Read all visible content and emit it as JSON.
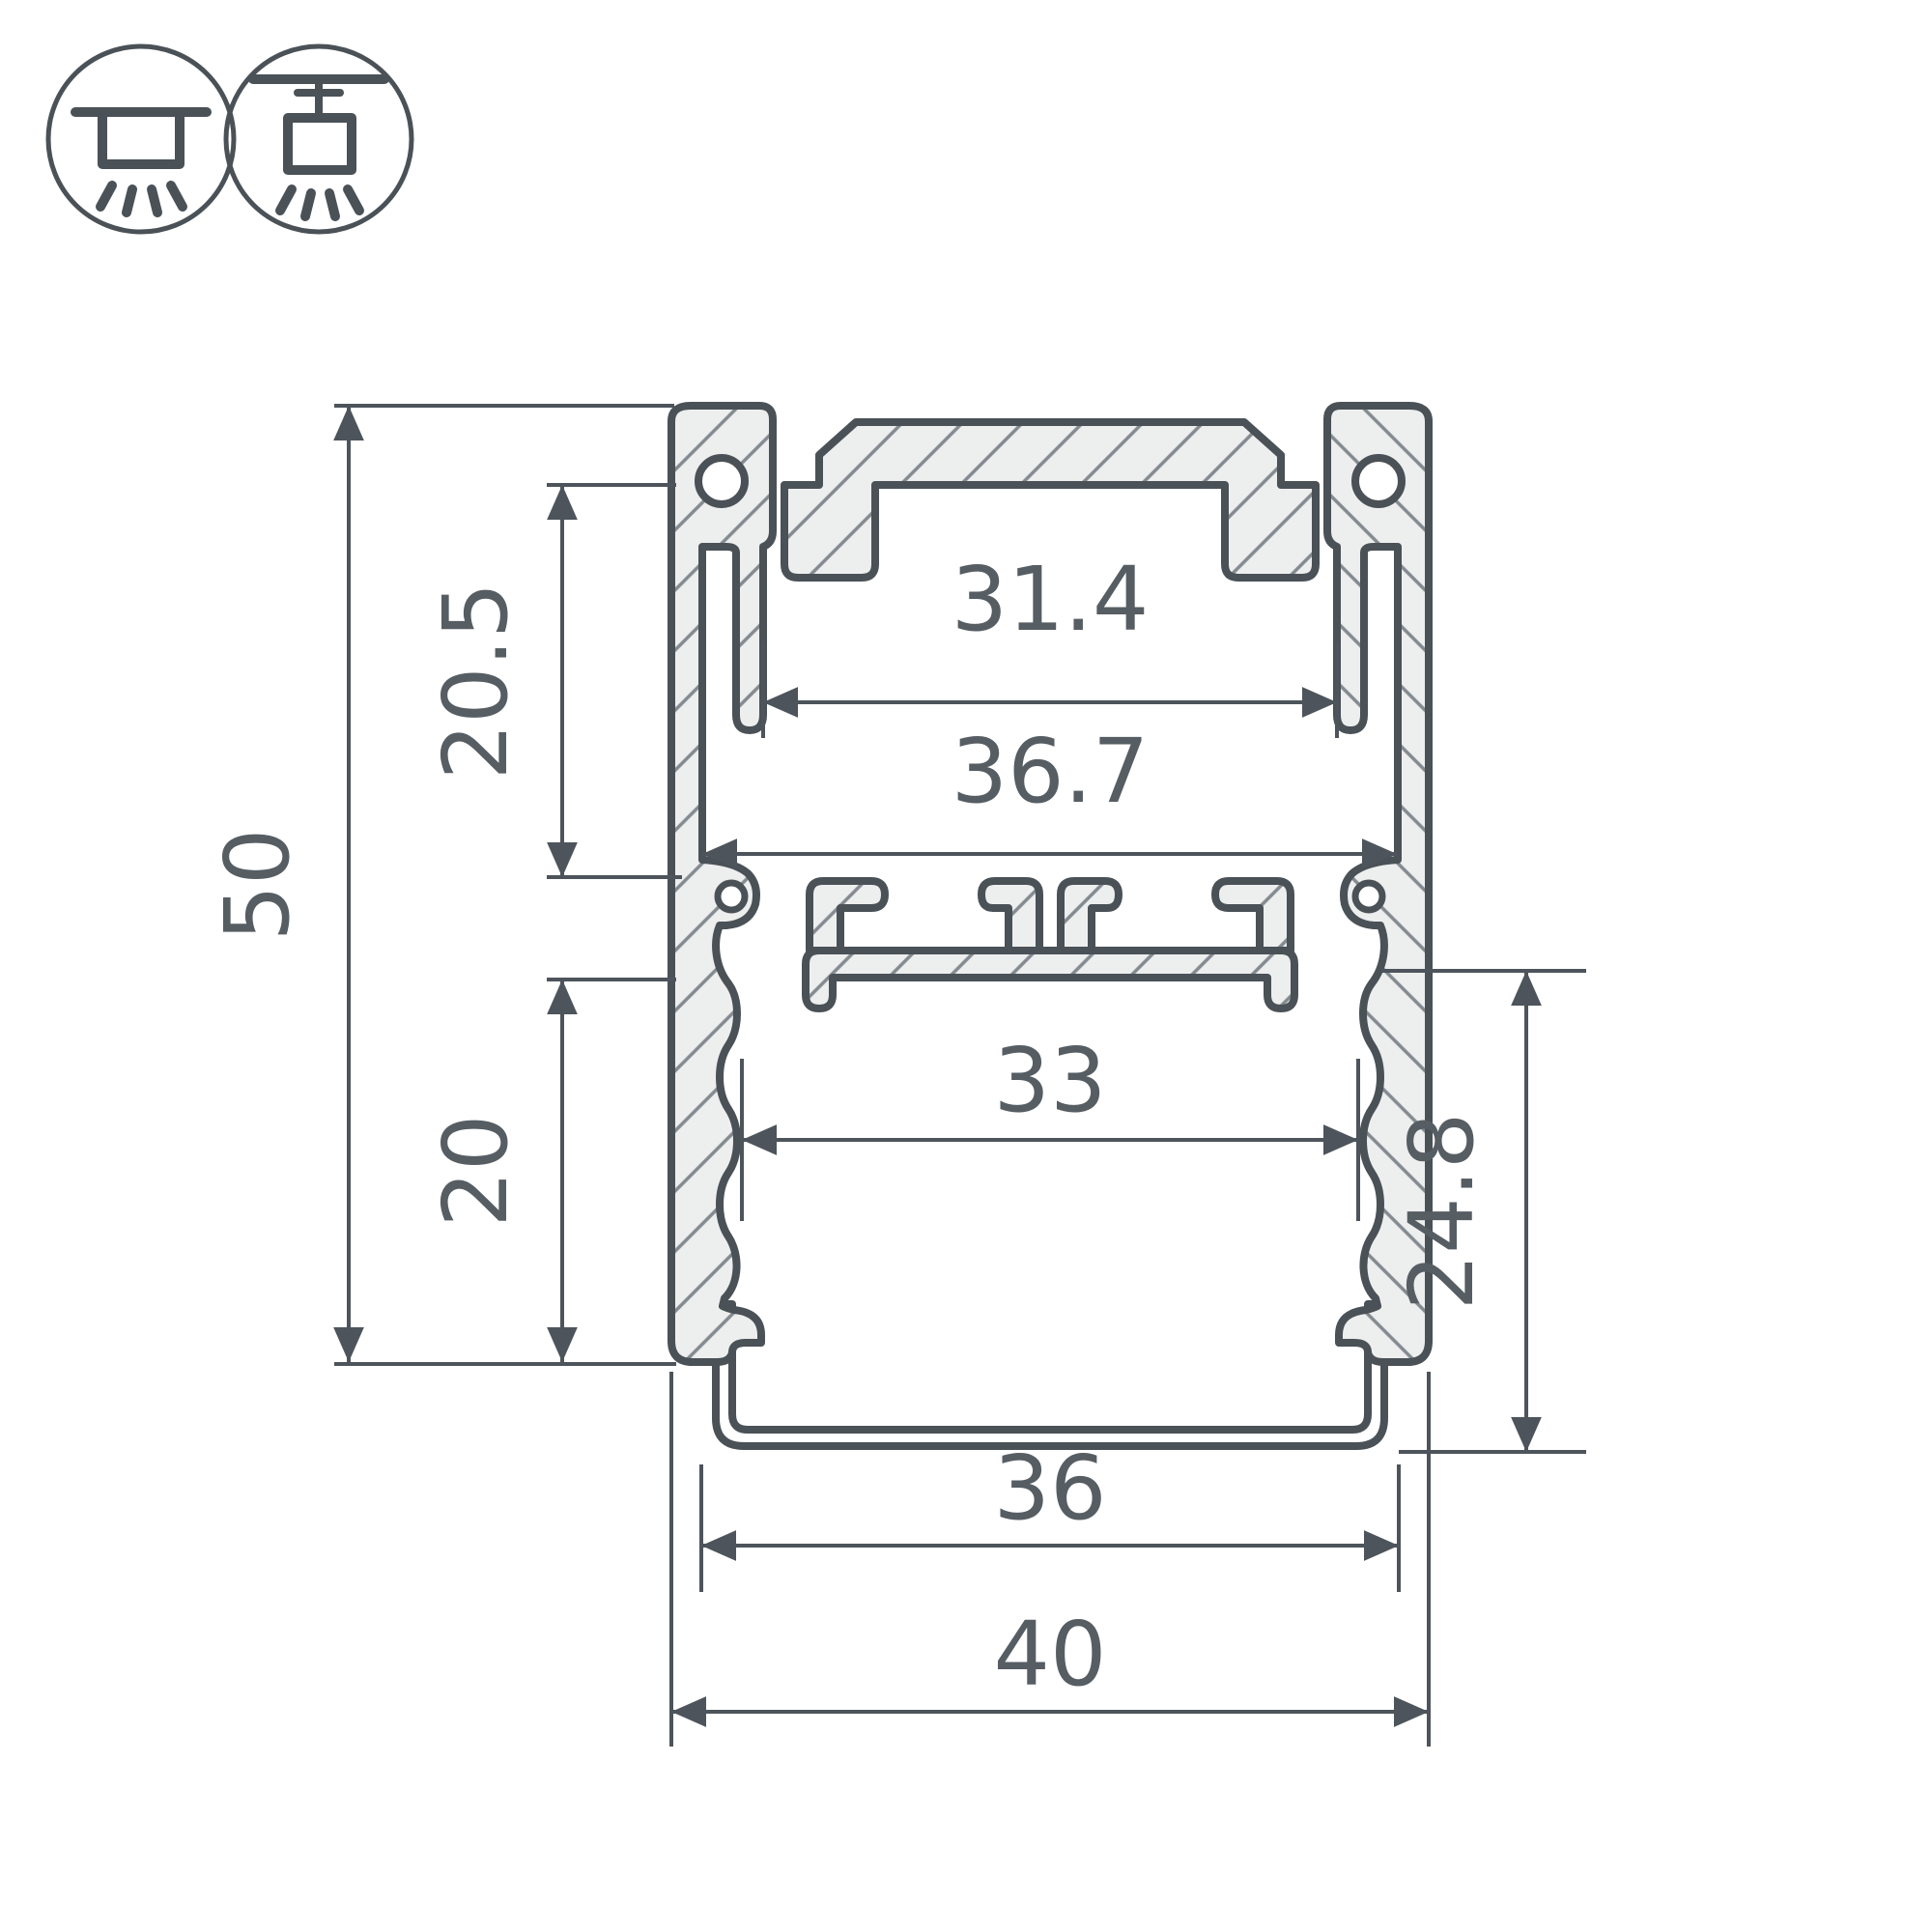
{
  "drawing": {
    "type": "profile-cross-section",
    "mount_icons": [
      {
        "name": "surface-mount-icon",
        "meaning": "surface ceiling mounted luminaire"
      },
      {
        "name": "pendant-mount-icon",
        "meaning": "suspended / pendant mounted luminaire"
      }
    ],
    "dims": {
      "d31_4": "31.4",
      "d36_7": "36.7",
      "d20_5": "20.5",
      "d50": "50",
      "d20": "20",
      "d33": "33",
      "d24_8": "24.8",
      "d36": "36",
      "d40": "40"
    },
    "colors": {
      "line": "#4a5157",
      "dim_line": "#4d545b",
      "text": "#565d63",
      "aluminium_fill": "#edeeee",
      "hatch_line": "#848b90",
      "background": "#ffffff"
    }
  }
}
